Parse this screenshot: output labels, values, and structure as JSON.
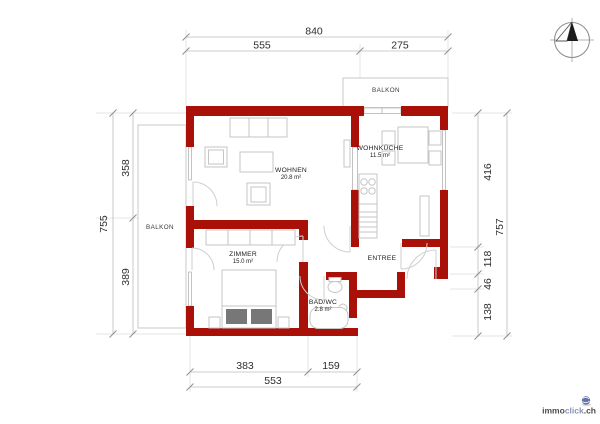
{
  "colors": {
    "wall": "#A81008",
    "dimension_line": "#BDBDBD",
    "text": "#2E2E2E",
    "furniture_outline": "#C6C6C6",
    "logo_dark": "#4A4A4A",
    "logo_accent": "#8893B8",
    "globe": "#6374A6"
  },
  "rooms": {
    "wohnen": {
      "name": "WOHNEN",
      "area": "20.8 m²"
    },
    "wohnkueche": {
      "name": "WOHNKÜCHE",
      "area": "11.5 m²"
    },
    "zimmer": {
      "name": "ZIMMER",
      "area": "15.0 m²"
    },
    "bad": {
      "name": "BAD/WC",
      "area": "2.8 m²"
    },
    "entree": {
      "name": "ENTREE"
    },
    "balkon_left": {
      "name": "BALKON"
    },
    "balkon_top": {
      "name": "BALKON"
    }
  },
  "dims": {
    "top_total": "840",
    "top_left": "555",
    "top_right": "275",
    "left_total": "755",
    "left_upper": "358",
    "left_lower": "389",
    "right_a": "416",
    "right_b": "118",
    "right_c": "46",
    "right_d": "138",
    "right_total": "757",
    "bottom_left": "383",
    "bottom_right": "159",
    "bottom_total": "553"
  },
  "logo": {
    "part1": "immo",
    "part2": "click",
    "part3": ".ch"
  }
}
